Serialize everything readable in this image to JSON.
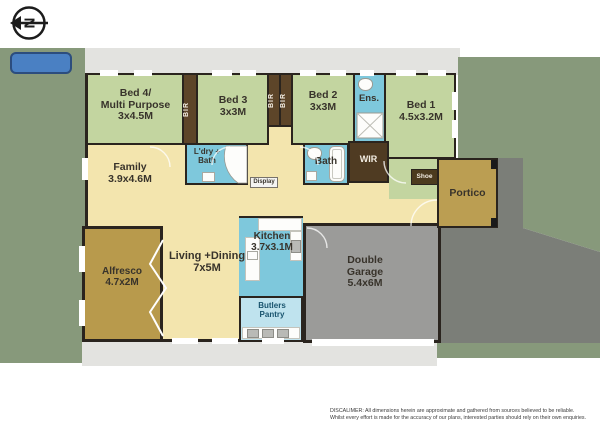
{
  "compass": {
    "letter": "N"
  },
  "rooms": {
    "bed4": {
      "name": "Bed 4/",
      "name2": "Multi Purpose",
      "dims": "3x4.5M"
    },
    "bed3": {
      "name": "Bed 3",
      "dims": "3x3M"
    },
    "bed2": {
      "name": "Bed 2",
      "dims": "3x3M"
    },
    "bed1": {
      "name": "Bed 1",
      "dims": "4.5x3.2M"
    },
    "ensuite": {
      "name": "Ens."
    },
    "bir": {
      "name": "BIR"
    },
    "wir": {
      "name": "WIR"
    },
    "family": {
      "name": "Family",
      "dims": "3.9x4.6M"
    },
    "ldry": {
      "name": "L'dry +",
      "name2": "Bath"
    },
    "bath": {
      "name": "Bath"
    },
    "display": {
      "name": "Display"
    },
    "shoe": {
      "name": "Shoe"
    },
    "portico": {
      "name": "Portico"
    },
    "alfresco": {
      "name": "Alfresco",
      "dims": "4.7x2M"
    },
    "living": {
      "name": "Living +Dining",
      "dims": "7x5M"
    },
    "kitchen": {
      "name": "Kitchen",
      "dims": "3.7x3.1M"
    },
    "pantry": {
      "name": "Butlers",
      "name2": "Pantry"
    },
    "garage": {
      "name": "Double",
      "name2": "Garage",
      "dims": "5.4x6M"
    }
  },
  "disclaimer": {
    "line1": "DISCALIMER:  All dimensions herein are approximate and gathered from sources believed to be reliable.",
    "line2": "Whilst every effort is made for the accuracy of our plans, interested parties should rely on their own enquiries."
  },
  "colors": {
    "yard_green": "#87997b",
    "concrete": "#e3e3e0",
    "driveway_gray": "#7b7e78",
    "bedroom_green": "#c3d5a0",
    "cream": "#f3e5ae",
    "wet_blue": "#7ec8dc",
    "pantry_blue": "#bfe3ee",
    "robe_brown": "#5d4529",
    "gold_tan": "#b89a4c",
    "garage_gray": "#9b9b99",
    "wall": "#2a241e",
    "tank_blue": "#4a80c3"
  }
}
